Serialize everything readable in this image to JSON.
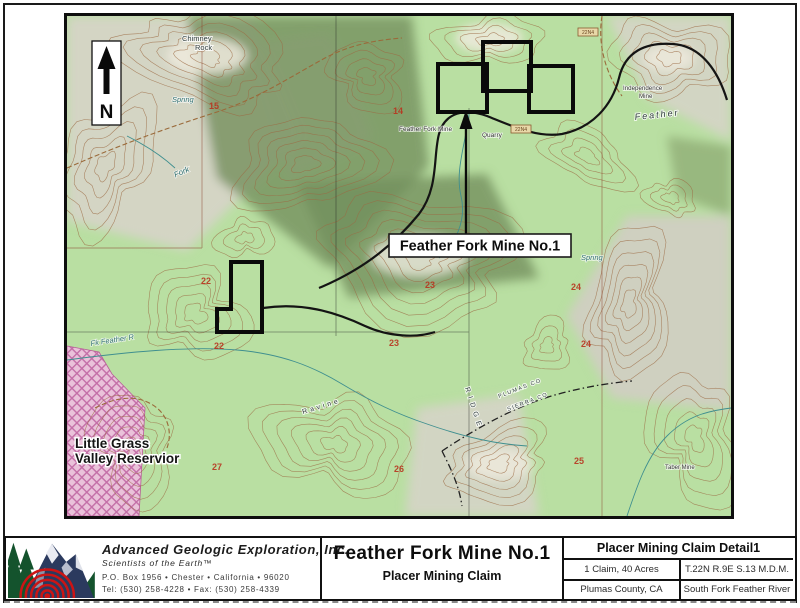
{
  "map": {
    "north": "N",
    "callout": "Feather Fork Mine No.1",
    "reservoir_line1": "Little Grass",
    "reservoir_line2": "Valley Reservior",
    "labels": {
      "chimney1": "Chimney",
      "chimney2": "Rock",
      "spring_left": "Spring",
      "spring_right": "Spring",
      "fork": "Fork",
      "feather_fork_mine": "Feather Fork Mine",
      "quarry": "Quarry",
      "independence1": "Independence",
      "independence2": "Mine",
      "feather": "Feather",
      "taber_mine": "Taber Mine",
      "fk_feather_r": "Fk Feather R",
      "ravine": "Ravine",
      "ridge": "RIDGE",
      "plumas_co": "PLUMAS CO",
      "sierra_co": "SIERRA CO"
    },
    "road_badges": {
      "b1": "22N4",
      "b2": "22N4"
    },
    "sections": {
      "s14": "14",
      "s15": "15",
      "s22a": "22",
      "s22b": "22",
      "s23a": "23",
      "s23b": "23",
      "s24a": "24",
      "s24b": "24",
      "s25": "25",
      "s26": "26",
      "s27": "27"
    }
  },
  "title_block": {
    "company": {
      "name": "Advanced Geologic Exploration, Inc.",
      "tagline": "Scientists of the Earth™",
      "address": "P.O. Box 1956 • Chester • California • 96020",
      "phone": "Tel: (530) 258-4228 • Fax: (530) 258-4339"
    },
    "title": "Feather Fork Mine No.1",
    "subtitle": "Placer Mining Claim",
    "detail": {
      "header": "Placer Mining Claim Detail1",
      "claim_size": "1 Claim, 40 Acres",
      "township": "T.22N R.9E S.13 M.D.M.",
      "county": "Plumas County, CA",
      "river": "South Fork Feather River"
    }
  }
}
